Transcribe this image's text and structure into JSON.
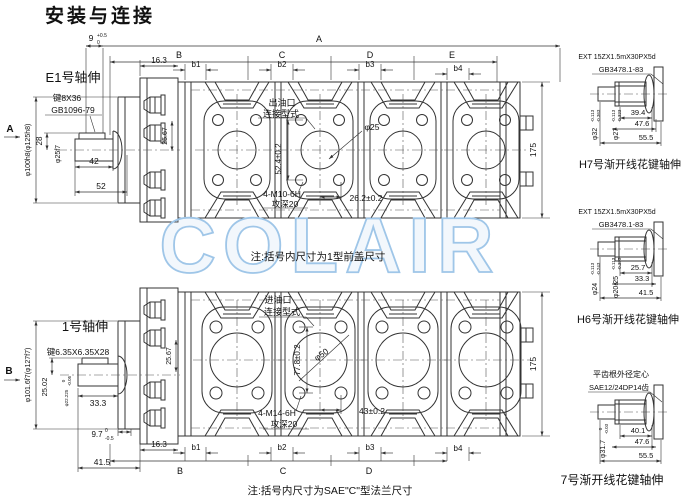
{
  "title": "安装与连接",
  "watermark": "COLAIR",
  "colors": {
    "title": "#00b2e8",
    "watermark": "#9fc6e8",
    "line": "#333333"
  },
  "notes": {
    "top_view": "注:括号内尺寸为1型前盖尺寸",
    "bottom_view": "注:括号内尺寸为SAE\"C\"型法兰尺寸"
  },
  "top_view": {
    "label": "E1号轴伸",
    "section_mark": "A",
    "key": "键8X36",
    "key_std": "GB1096-79",
    "pilot_dia": "φ100h8(φ125h8)",
    "shaft_dia": "φ25f7",
    "dim_28": "28",
    "dim_42": "42",
    "dim_52": "52",
    "dim_9": "9",
    "dim_9_up": "+0.5",
    "dim_9_dn": "0",
    "dim_163": "16.3",
    "dim_2567": "25.67",
    "dim_175": "175",
    "overall": "A",
    "seg_b": "B",
    "seg_c": "C",
    "seg_d": "D",
    "seg_e": "E",
    "b1": "b1",
    "b2": "b2",
    "b3": "b3",
    "b4": "b4",
    "port_line1": "出油口",
    "port_line2": "连接型式",
    "port_dia": "φ25",
    "dim_524": "52.4±0.2",
    "tap": "4-M10-6H",
    "tap_depth": "攻深20",
    "dim_262": "26.2±0.2"
  },
  "bottom_view": {
    "label": "1号轴伸",
    "section_mark": "B",
    "key": "键6.35X6.35X28",
    "pilot_dia": "φ101.6f7(φ127f7)",
    "shaft_dia": "φ22.225",
    "shaft_dia_up": "0",
    "shaft_dia_dn": "-0.05",
    "dim_2502": "25.02",
    "dim_333": "33.3",
    "dim_97": "9.7",
    "dim_97_up": "0",
    "dim_97_dn": "-0.5",
    "dim_415": "41.5",
    "dim_163": "16.3",
    "dim_2567": "25.67",
    "dim_175": "175",
    "seg_b": "B",
    "seg_c": "C",
    "seg_d": "D",
    "b1": "b1",
    "b2": "b2",
    "b3": "b3",
    "b4": "b4",
    "port_line1": "进油口",
    "port_line2": "连接型式",
    "port_dia": "φ50",
    "dim_778": "77.8±0.2",
    "tap": "4-M14-6H",
    "tap_depth": "攻深20",
    "dim_43": "43±0.2"
  },
  "spline_h7": {
    "spec": "EXT 15ZX1.5mX30PX5d",
    "std": "GB3478.1-83",
    "d1": "φ32",
    "d1_up": "-0.113",
    "d1_dn": "-0.363",
    "d2": "φ27",
    "d2_up": "-0.113",
    "d2_dn": "-0.323",
    "l1": "39.4",
    "l2": "47.6",
    "l3": "55.5",
    "label": "H7号渐开线花键轴伸"
  },
  "spline_h6": {
    "spec": "EXT 15ZX1.5mX30PX5d",
    "std": "GB3478.1-83",
    "d1": "φ24",
    "d1_up": "-0.113",
    "d1_dn": "-0.243",
    "d2": "φ20.25",
    "d2_up": "-0.113",
    "d2_dn": "-0.393",
    "l1": "25.7",
    "l2": "33.3",
    "l3": "41.5",
    "label": "H6号渐开线花键轴伸"
  },
  "spline_7": {
    "spec_line1": "平齿根外径定心",
    "spec_line2": "SAE12/24DP14齿",
    "d1": "φ31.7",
    "d1_up": "0",
    "d1_dn": "-0.03",
    "l1": "40.1",
    "l2": "47.6",
    "l3": "55.5",
    "label": "7号渐开线花键轴伸"
  }
}
